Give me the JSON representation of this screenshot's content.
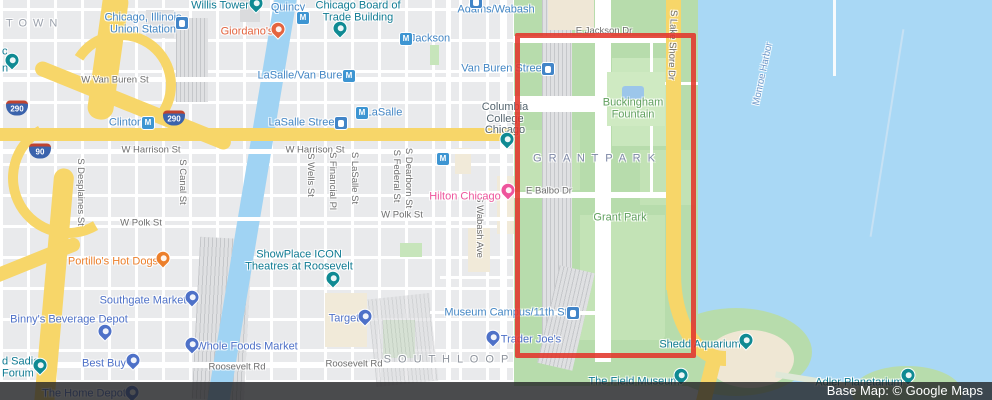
{
  "attribution": {
    "text": "Base Map: © Google Maps"
  },
  "colors": {
    "transit_blue": "#4487c5",
    "shopping_blue": "#4e71c8",
    "attraction_teal": "#0f7b93",
    "food_orange": "#ec7f2b",
    "food_red_orange": "#e4643f",
    "hotel_pink": "#ee549c",
    "park_green_label": "#61a05f",
    "water_label": "#7198c8",
    "street_gray": "#6e6e6e",
    "neighborhood_gray": "#8d939c",
    "grant_park_gray": "#7e88a6",
    "highlight_red": "#e2352b",
    "road_yellow": "#f7d669",
    "park_fill": "#b7dcac",
    "water_fill": "#a9d8f5"
  },
  "highlight_rect": {
    "x": 515,
    "y": 33,
    "w": 181,
    "h": 325
  },
  "map_labels": [
    {
      "t": "KTOWN",
      "x": 28,
      "y": 24,
      "cls": "nbhd",
      "col": "#9aa0ab",
      "ls": 6,
      "it": 0
    },
    {
      "t": "Chicago, Illinois\nUnion Station",
      "x": 143,
      "y": 24,
      "cls": "poi",
      "col": "#4487c5",
      "it": 1
    },
    {
      "t": "Willis Tower",
      "x": 220,
      "y": 6,
      "cls": "poi",
      "col": "#0f7b93",
      "it": 1
    },
    {
      "t": "Quincy",
      "x": 288,
      "y": 8,
      "cls": "poi",
      "col": "#4487c5",
      "it": 1
    },
    {
      "t": "Chicago Board of\nTrade Building",
      "x": 358,
      "y": 12,
      "cls": "poi",
      "col": "#0f7b93",
      "it": 1
    },
    {
      "t": "Jackson",
      "x": 430,
      "y": 39,
      "cls": "poi",
      "col": "#4487c5",
      "it": 1
    },
    {
      "t": "Adams/Wabash",
      "x": 496,
      "y": 10,
      "cls": "poi",
      "col": "#4487c5",
      "it": 1
    },
    {
      "t": "Giordano's",
      "x": 247,
      "y": 32,
      "cls": "poi",
      "col": "#e4643f",
      "it": 1
    },
    {
      "t": "W Van Buren St",
      "x": 115,
      "y": 80,
      "cls": "street",
      "it": 0
    },
    {
      "t": "LaSalle/Van Buren",
      "x": 303,
      "y": 76,
      "cls": "poi",
      "col": "#4487c5",
      "it": 1
    },
    {
      "t": "Van Buren Street",
      "x": 503,
      "y": 69,
      "cls": "poi",
      "col": "#4487c5",
      "it": 1
    },
    {
      "t": "LaSalle",
      "x": 384,
      "y": 113,
      "cls": "poi",
      "col": "#4487c5",
      "it": 1
    },
    {
      "t": "LaSalle Street",
      "x": 303,
      "y": 123,
      "cls": "poi",
      "col": "#4487c5",
      "it": 1
    },
    {
      "t": "Clinton",
      "x": 126,
      "y": 123,
      "cls": "poi",
      "col": "#4487c5",
      "it": 1
    },
    {
      "t": "E Jackson Dr",
      "x": 604,
      "y": 31,
      "cls": "street",
      "it": 0
    },
    {
      "t": "Columbia\nCollege\nChicago",
      "x": 505,
      "y": 119,
      "cls": "poi",
      "col": "#55656f",
      "it": 1
    },
    {
      "t": "Buckingham\nFountain",
      "x": 633,
      "y": 109,
      "cls": "poi",
      "col": "#61a05f",
      "it": 1
    },
    {
      "t": "S Lake Shore Dr",
      "x": 672,
      "y": 45,
      "cls": "street",
      "rot": 92,
      "it": 0
    },
    {
      "t": "Monroe Harbor",
      "x": 763,
      "y": 74,
      "cls": "street",
      "col": "#7198c8",
      "rot": -78,
      "it": 0
    },
    {
      "t": "G R A N T   P A R K",
      "x": 595,
      "y": 159,
      "cls": "nbhd",
      "col": "#7e88a6",
      "ls": 2,
      "it": 0
    },
    {
      "t": "W Harrison St",
      "x": 151,
      "y": 150,
      "cls": "street",
      "it": 0
    },
    {
      "t": "W Harrison St",
      "x": 315,
      "y": 150,
      "cls": "street",
      "it": 0
    },
    {
      "t": "S Desplaines St",
      "x": 80,
      "y": 192,
      "cls": "street",
      "rot": 90,
      "it": 0
    },
    {
      "t": "S Canal St",
      "x": 182,
      "y": 182,
      "cls": "street",
      "rot": 90,
      "it": 0
    },
    {
      "t": "S Wells St",
      "x": 310,
      "y": 175,
      "cls": "street",
      "rot": 90,
      "it": 0
    },
    {
      "t": "S Financial Pl",
      "x": 332,
      "y": 181,
      "cls": "street",
      "rot": 90,
      "it": 0
    },
    {
      "t": "S LaSalle St",
      "x": 354,
      "y": 178,
      "cls": "street",
      "rot": 90,
      "it": 0
    },
    {
      "t": "S Federal St",
      "x": 396,
      "y": 176,
      "cls": "street",
      "rot": 90,
      "it": 0
    },
    {
      "t": "S Dearborn St",
      "x": 408,
      "y": 178,
      "cls": "street",
      "rot": 90,
      "it": 0
    },
    {
      "t": "S Wabash Ave",
      "x": 479,
      "y": 227,
      "cls": "street",
      "rot": 90,
      "it": 0
    },
    {
      "t": "Hilton Chicago",
      "x": 465,
      "y": 197,
      "cls": "poi",
      "col": "#ee549c",
      "it": 1
    },
    {
      "t": "E Balbo Dr",
      "x": 549,
      "y": 191,
      "cls": "street",
      "it": 0
    },
    {
      "t": "Grant Park",
      "x": 620,
      "y": 218,
      "cls": "poi",
      "col": "#61a05f",
      "it": 1
    },
    {
      "t": "W Polk St",
      "x": 141,
      "y": 223,
      "cls": "street",
      "it": 0
    },
    {
      "t": "W Polk St",
      "x": 402,
      "y": 215,
      "cls": "street",
      "it": 0
    },
    {
      "t": "Portillo's Hot Dogs",
      "x": 113,
      "y": 262,
      "cls": "poi",
      "col": "#ec7f2b",
      "it": 1
    },
    {
      "t": "ShowPlace ICON\nTheatres at Roosevelt",
      "x": 299,
      "y": 261,
      "cls": "poi",
      "col": "#0f7b93",
      "it": 1
    },
    {
      "t": "Southgate Market",
      "x": 143,
      "y": 301,
      "cls": "poi",
      "col": "#4e71c8",
      "it": 1
    },
    {
      "t": "Binny's Beverage Depot",
      "x": 69,
      "y": 320,
      "cls": "poi",
      "col": "#4e71c8",
      "it": 1
    },
    {
      "t": "Target",
      "x": 344,
      "y": 319,
      "cls": "poi",
      "col": "#4e71c8",
      "it": 1
    },
    {
      "t": "Museum Campus/11th St",
      "x": 506,
      "y": 313,
      "cls": "poi",
      "col": "#4487c5",
      "it": 1
    },
    {
      "t": "Whole Foods Market",
      "x": 247,
      "y": 347,
      "cls": "poi",
      "col": "#4e71c8",
      "it": 1
    },
    {
      "t": "Trader Joe's",
      "x": 531,
      "y": 340,
      "cls": "poi",
      "col": "#4e71c8",
      "it": 1
    },
    {
      "t": "Best Buy",
      "x": 104,
      "y": 364,
      "cls": "poi",
      "col": "#4e71c8",
      "it": 1
    },
    {
      "t": "d Sadie\nForum",
      "x": 2,
      "y": 368,
      "cls": "poi",
      "col": "#0f7b93",
      "a": "l",
      "it": 1
    },
    {
      "t": "c",
      "x": 2,
      "y": 52,
      "cls": "poi",
      "col": "#0f7b93",
      "a": "l",
      "it": 1
    },
    {
      "t": "n",
      "x": 2,
      "y": 69,
      "cls": "poi",
      "col": "#0f7b93",
      "a": "l",
      "it": 1
    },
    {
      "t": "S O U T H   L O O P",
      "x": 447,
      "y": 360,
      "cls": "nbhd",
      "col": "#8d939c",
      "ls": 2,
      "it": 0
    },
    {
      "t": "Roosevelt Rd",
      "x": 237,
      "y": 367,
      "cls": "street",
      "it": 0
    },
    {
      "t": "Roosevelt Rd",
      "x": 354,
      "y": 364,
      "cls": "street",
      "it": 0
    },
    {
      "t": "Shedd Aquarium",
      "x": 700,
      "y": 345,
      "cls": "poi",
      "col": "#0f7b93",
      "it": 1
    },
    {
      "t": "The Home Depot",
      "x": 84,
      "y": 394,
      "cls": "poi",
      "col": "#4e71c8",
      "it": 1
    },
    {
      "t": "The Field Museum",
      "x": 634,
      "y": 382,
      "cls": "poi",
      "col": "#0f7b93",
      "it": 1
    },
    {
      "t": "Adler Planetarium",
      "x": 859,
      "y": 383,
      "cls": "poi",
      "col": "#0f7b93",
      "it": 1
    }
  ],
  "pins": [
    {
      "x": 256,
      "y": 5,
      "c": "#0f8a93",
      "name": "willis-tower-pin"
    },
    {
      "x": 340,
      "y": 30,
      "c": "#0f8a93",
      "name": "board-of-trade-pin"
    },
    {
      "x": 278,
      "y": 31,
      "c": "#e4643f",
      "name": "giordanos-restaurant-pin"
    },
    {
      "x": 12,
      "y": 62,
      "c": "#0f8a93",
      "name": "poi-pin-left-edge"
    },
    {
      "x": 507,
      "y": 141,
      "c": "#0f8a93",
      "name": "columbia-college-pin"
    },
    {
      "x": 508,
      "y": 192,
      "c": "#ee549c",
      "name": "hilton-chicago-hotel-pin"
    },
    {
      "x": 163,
      "y": 260,
      "c": "#ec7f2b",
      "name": "portillos-restaurant-pin"
    },
    {
      "x": 333,
      "y": 280,
      "c": "#0f8a93",
      "name": "showplace-icon-theatre-pin"
    },
    {
      "x": 192,
      "y": 299,
      "c": "#4e71c8",
      "name": "southgate-market-pin"
    },
    {
      "x": 105,
      "y": 333,
      "c": "#4e71c8",
      "name": "binnys-beverage-depot-pin"
    },
    {
      "x": 365,
      "y": 318,
      "c": "#4e71c8",
      "name": "target-pin"
    },
    {
      "x": 192,
      "y": 346,
      "c": "#4e71c8",
      "name": "whole-foods-pin"
    },
    {
      "x": 133,
      "y": 362,
      "c": "#4e71c8",
      "name": "best-buy-pin"
    },
    {
      "x": 493,
      "y": 339,
      "c": "#4e71c8",
      "name": "trader-joes-pin"
    },
    {
      "x": 40,
      "y": 367,
      "c": "#0f8a93",
      "name": "sadie-forum-pin"
    },
    {
      "x": 132,
      "y": 394,
      "c": "#4e71c8",
      "name": "home-depot-pin"
    },
    {
      "x": 746,
      "y": 342,
      "c": "#0f8a93",
      "name": "shedd-aquarium-pin"
    },
    {
      "x": 681,
      "y": 377,
      "c": "#0f8a93",
      "name": "field-museum-pin"
    },
    {
      "x": 908,
      "y": 377,
      "c": "#0f8a93",
      "name": "adler-planetarium-pin"
    }
  ],
  "transit_icons": [
    {
      "x": 303,
      "y": 18,
      "k": "metro",
      "name": "quincy-metro-icon"
    },
    {
      "x": 406,
      "y": 39,
      "k": "metro",
      "name": "jackson-metro-icon"
    },
    {
      "x": 349,
      "y": 76,
      "k": "metro",
      "name": "lasalle-van-buren-metro-icon"
    },
    {
      "x": 362,
      "y": 113,
      "k": "metro",
      "name": "lasalle-metro-icon"
    },
    {
      "x": 148,
      "y": 123,
      "k": "metro",
      "name": "clinton-metro-icon"
    },
    {
      "x": 443,
      "y": 159,
      "k": "metro",
      "name": "metro-icon"
    },
    {
      "x": 182,
      "y": 23,
      "k": "station",
      "name": "union-station-rail-icon"
    },
    {
      "x": 548,
      "y": 69,
      "k": "station",
      "name": "van-buren-street-rail-icon"
    },
    {
      "x": 341,
      "y": 123,
      "k": "station",
      "name": "lasalle-street-rail-icon"
    },
    {
      "x": 573,
      "y": 313,
      "k": "station",
      "name": "museum-campus-rail-icon"
    },
    {
      "x": 476,
      "y": 2,
      "k": "station",
      "name": "adams-wabash-rail-icon"
    }
  ],
  "highway_shields": [
    {
      "x": 17,
      "y": 108,
      "n": "290"
    },
    {
      "x": 174,
      "y": 118,
      "n": "290"
    },
    {
      "x": 40,
      "y": 151,
      "n": "90"
    }
  ]
}
